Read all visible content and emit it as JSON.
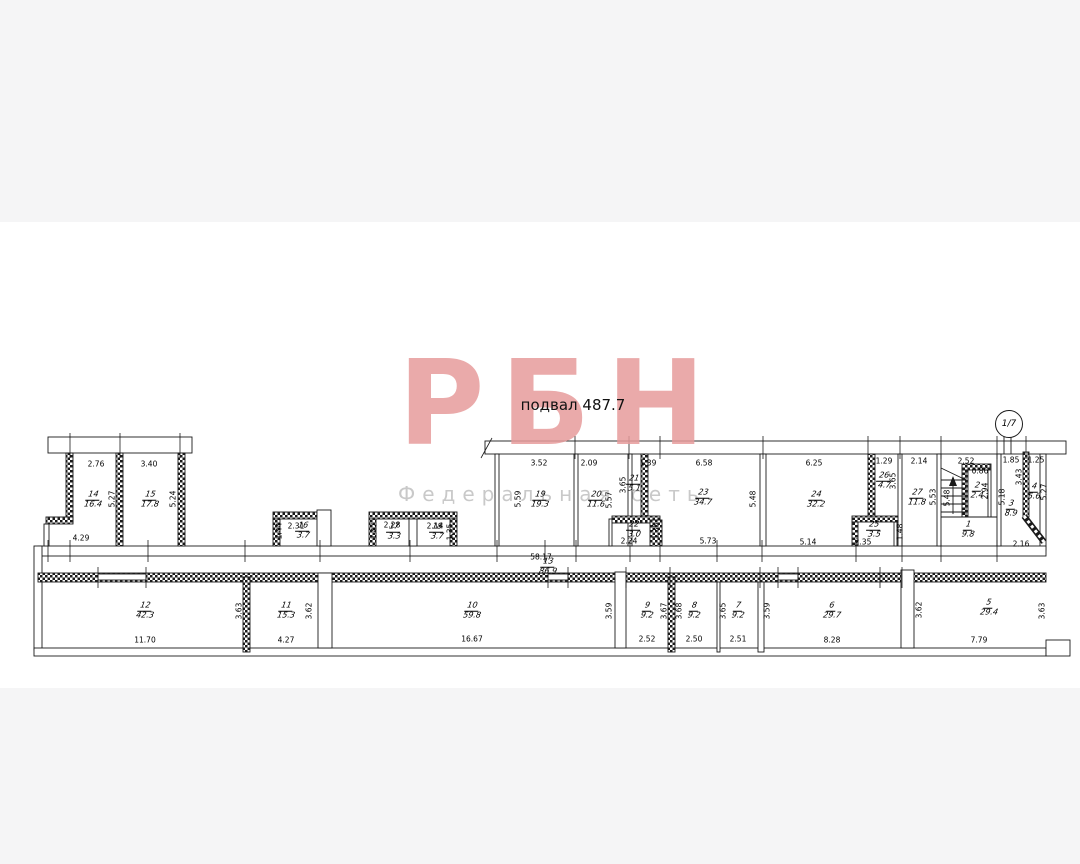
{
  "title": "подвал 487.7",
  "marker": "1/7",
  "watermark": {
    "text": "РБН",
    "subtitle": "Федеральная сеть"
  },
  "rooms": [
    {
      "n": "14",
      "a": "16.4",
      "x": 93,
      "y": 500
    },
    {
      "n": "15",
      "a": "17.8",
      "x": 150,
      "y": 500
    },
    {
      "n": "16",
      "a": "3.7",
      "x": 303,
      "y": 531
    },
    {
      "n": "17",
      "a": "3.3",
      "x": 394,
      "y": 532
    },
    {
      "n": "18",
      "a": "3.7",
      "x": 437,
      "y": 532
    },
    {
      "n": "19",
      "a": "19.3",
      "x": 540,
      "y": 500
    },
    {
      "n": "20",
      "a": "11.6",
      "x": 596,
      "y": 500
    },
    {
      "n": "21",
      "a": "5.1",
      "x": 634,
      "y": 484
    },
    {
      "n": "22",
      "a": "3.0",
      "x": 634,
      "y": 530
    },
    {
      "n": "23",
      "a": "34.7",
      "x": 703,
      "y": 498
    },
    {
      "n": "24",
      "a": "32.2",
      "x": 816,
      "y": 500
    },
    {
      "n": "25",
      "a": "3.5",
      "x": 874,
      "y": 530
    },
    {
      "n": "26",
      "a": "4.7",
      "x": 884,
      "y": 481
    },
    {
      "n": "27",
      "a": "11.8",
      "x": 917,
      "y": 498
    },
    {
      "n": "1",
      "a": "9.8",
      "x": 968,
      "y": 530
    },
    {
      "n": "2",
      "a": "2.4",
      "x": 977,
      "y": 491
    },
    {
      "n": "3",
      "a": "8.9",
      "x": 1011,
      "y": 509
    },
    {
      "n": "4",
      "a": "5.6",
      "x": 1034,
      "y": 492
    },
    {
      "n": "5",
      "a": "29.4",
      "x": 989,
      "y": 608
    },
    {
      "n": "6",
      "a": "29.7",
      "x": 832,
      "y": 611
    },
    {
      "n": "7",
      "a": "9.2",
      "x": 738,
      "y": 611
    },
    {
      "n": "8",
      "a": "9.2",
      "x": 694,
      "y": 611
    },
    {
      "n": "9",
      "a": "9.2",
      "x": 647,
      "y": 611
    },
    {
      "n": "10",
      "a": "59.8",
      "x": 472,
      "y": 611
    },
    {
      "n": "11",
      "a": "15.3",
      "x": 286,
      "y": 611
    },
    {
      "n": "12",
      "a": "42.3",
      "x": 145,
      "y": 611
    },
    {
      "n": "13",
      "a": "86.9",
      "x": 548,
      "y": 567
    }
  ],
  "dims": [
    {
      "t": "2.76",
      "x": 96,
      "y": 464
    },
    {
      "t": "3.40",
      "x": 149,
      "y": 464
    },
    {
      "t": "4.29",
      "x": 81,
      "y": 538
    },
    {
      "t": "2.31",
      "x": 296,
      "y": 526
    },
    {
      "t": "2.28",
      "x": 392,
      "y": 525
    },
    {
      "t": "2.14",
      "x": 435,
      "y": 526
    },
    {
      "t": "3.52",
      "x": 539,
      "y": 463
    },
    {
      "t": "2.09",
      "x": 589,
      "y": 463
    },
    {
      "t": "1.39",
      "x": 648,
      "y": 463
    },
    {
      "t": "6.58",
      "x": 704,
      "y": 463
    },
    {
      "t": "6.25",
      "x": 814,
      "y": 463
    },
    {
      "t": "1.29",
      "x": 884,
      "y": 461
    },
    {
      "t": "2.14",
      "x": 919,
      "y": 461
    },
    {
      "t": "2.52",
      "x": 966,
      "y": 461
    },
    {
      "t": "1.85",
      "x": 1011,
      "y": 460
    },
    {
      "t": "1.25",
      "x": 1036,
      "y": 460
    },
    {
      "t": "0.86",
      "x": 980,
      "y": 471
    },
    {
      "t": "2.24",
      "x": 629,
      "y": 541
    },
    {
      "t": "5.73",
      "x": 708,
      "y": 541
    },
    {
      "t": "5.14",
      "x": 808,
      "y": 542
    },
    {
      "t": "2.35",
      "x": 863,
      "y": 542
    },
    {
      "t": "2.16",
      "x": 1021,
      "y": 544
    },
    {
      "t": "58.17",
      "x": 541,
      "y": 557
    },
    {
      "t": "11.70",
      "x": 145,
      "y": 640
    },
    {
      "t": "4.27",
      "x": 286,
      "y": 640
    },
    {
      "t": "16.67",
      "x": 472,
      "y": 639
    },
    {
      "t": "2.52",
      "x": 647,
      "y": 639
    },
    {
      "t": "2.50",
      "x": 694,
      "y": 639
    },
    {
      "t": "2.51",
      "x": 738,
      "y": 639
    },
    {
      "t": "8.28",
      "x": 832,
      "y": 640
    },
    {
      "t": "7.79",
      "x": 979,
      "y": 640
    },
    {
      "t": "5.27",
      "x": 112,
      "y": 499,
      "v": 1
    },
    {
      "t": "5.24",
      "x": 173,
      "y": 499,
      "v": 1
    },
    {
      "t": "1.44",
      "x": 279,
      "y": 531,
      "v": 1
    },
    {
      "t": "1.47",
      "x": 374,
      "y": 531,
      "v": 1
    },
    {
      "t": "1.35",
      "x": 450,
      "y": 532,
      "v": 1
    },
    {
      "t": "5.59",
      "x": 518,
      "y": 499,
      "v": 1
    },
    {
      "t": "5.57",
      "x": 609,
      "y": 500,
      "v": 1
    },
    {
      "t": "3.65",
      "x": 623,
      "y": 485,
      "v": 1
    },
    {
      "t": "1.35",
      "x": 656,
      "y": 531,
      "v": 1
    },
    {
      "t": "5.48",
      "x": 753,
      "y": 499,
      "v": 1
    },
    {
      "t": "3.65",
      "x": 893,
      "y": 481,
      "v": 1
    },
    {
      "t": "5.53",
      "x": 933,
      "y": 497,
      "v": 1
    },
    {
      "t": "5.48",
      "x": 947,
      "y": 498,
      "v": 1
    },
    {
      "t": "2.94",
      "x": 985,
      "y": 491,
      "v": 1
    },
    {
      "t": "1.48",
      "x": 900,
      "y": 532,
      "v": 1
    },
    {
      "t": "5.18",
      "x": 1002,
      "y": 497,
      "v": 1
    },
    {
      "t": "3.43",
      "x": 1019,
      "y": 477,
      "v": 1
    },
    {
      "t": "5.27",
      "x": 1044,
      "y": 492,
      "v": 1
    },
    {
      "t": "3.63",
      "x": 239,
      "y": 611,
      "v": 1
    },
    {
      "t": "3.62",
      "x": 309,
      "y": 611,
      "v": 1
    },
    {
      "t": "3.59",
      "x": 609,
      "y": 611,
      "v": 1
    },
    {
      "t": "3.67",
      "x": 664,
      "y": 611,
      "v": 1
    },
    {
      "t": "3.68",
      "x": 679,
      "y": 611,
      "v": 1
    },
    {
      "t": "3.65",
      "x": 723,
      "y": 611,
      "v": 1
    },
    {
      "t": "3.59",
      "x": 767,
      "y": 611,
      "v": 1
    },
    {
      "t": "3.62",
      "x": 919,
      "y": 610,
      "v": 1
    },
    {
      "t": "3.63",
      "x": 1042,
      "y": 611,
      "v": 1
    }
  ]
}
